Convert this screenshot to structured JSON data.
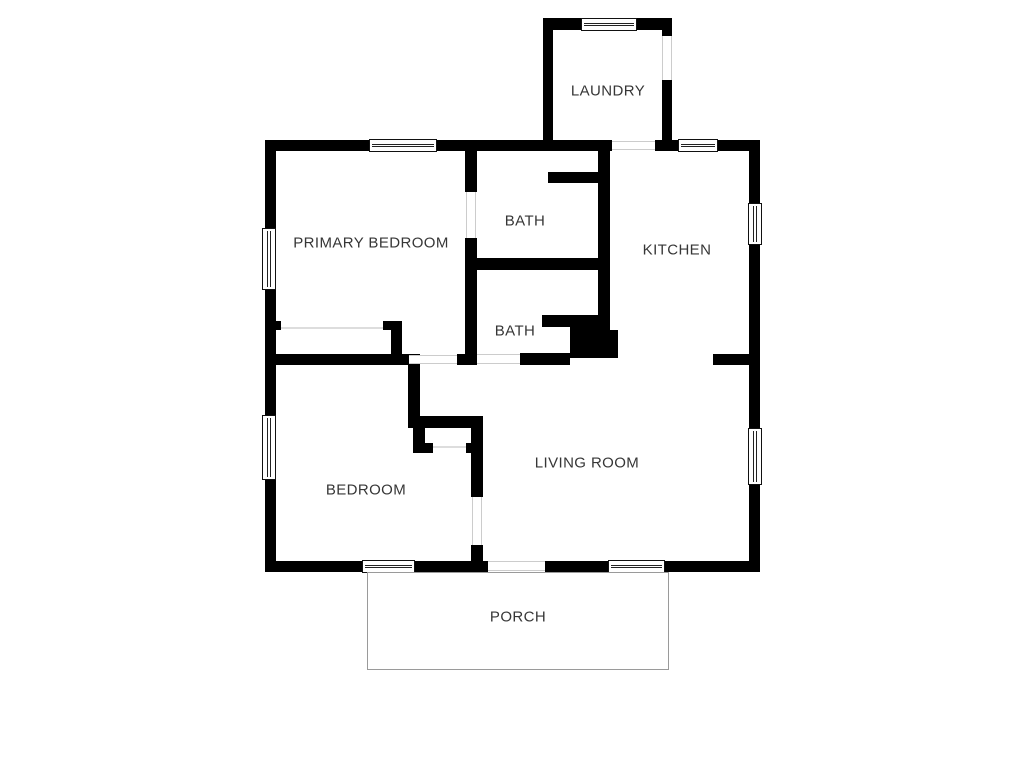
{
  "plan": {
    "type": "residential-floor-plan",
    "colors": {
      "wall": "#000000",
      "background": "#ffffff",
      "label_text": "#363636",
      "door_swing_line": "#cccccc",
      "porch_outline": "#9a9a9a"
    },
    "rooms": {
      "laundry": {
        "label": "LAUNDRY"
      },
      "primary_bedroom": {
        "label": "PRIMARY BEDROOM"
      },
      "bath_upper": {
        "label": "BATH"
      },
      "kitchen": {
        "label": "KITCHEN"
      },
      "bath_lower": {
        "label": "BATH"
      },
      "living_room": {
        "label": "LIVING ROOM"
      },
      "bedroom": {
        "label": "BEDROOM"
      },
      "porch": {
        "label": "PORCH"
      }
    }
  }
}
